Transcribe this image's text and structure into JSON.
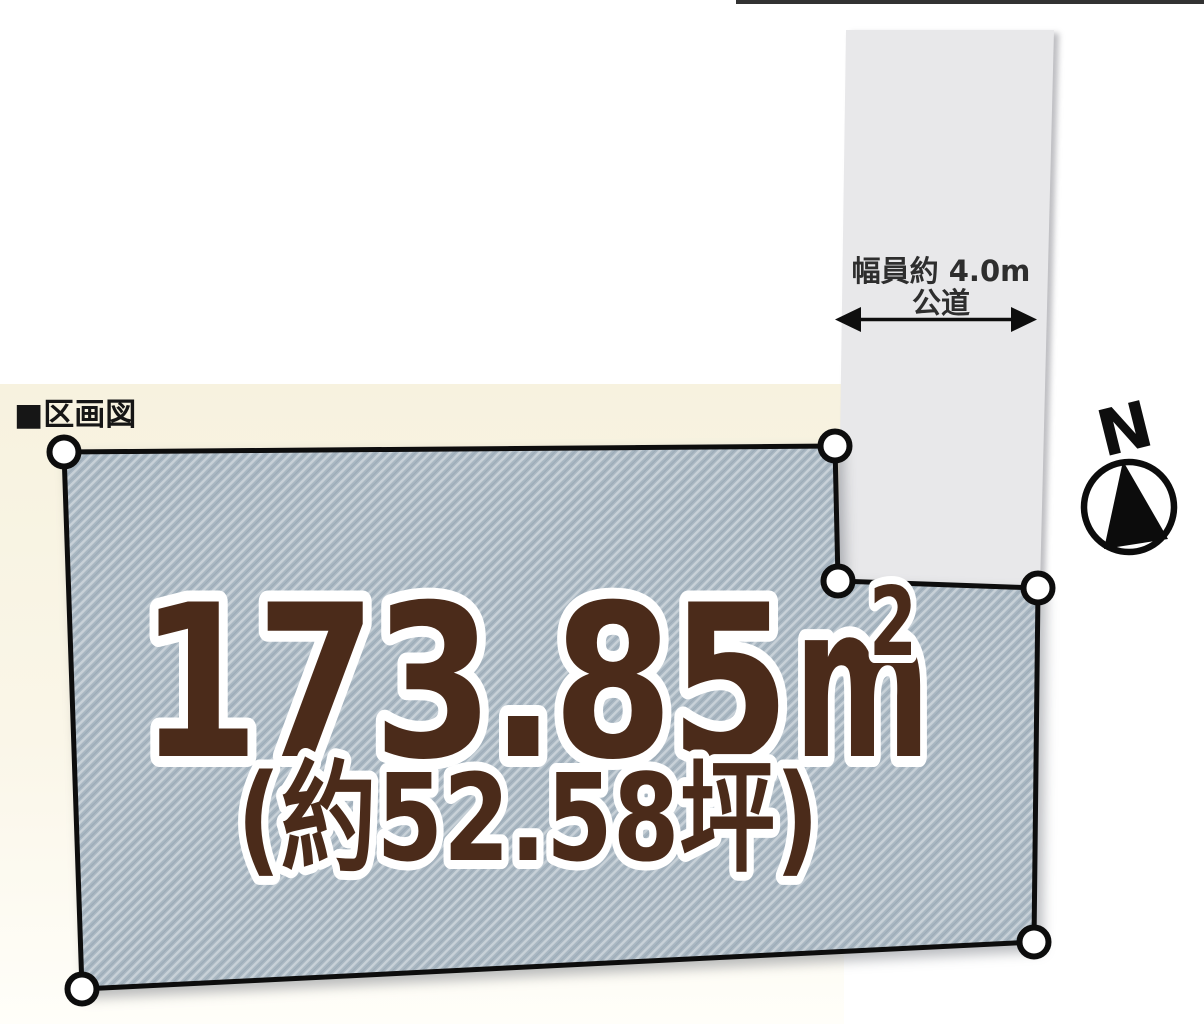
{
  "page": {
    "section_title": "■区画図"
  },
  "road": {
    "width_label": "幅員約 4.0m",
    "name_label": "公道"
  },
  "compass": {
    "north_label": "N"
  },
  "parcel": {
    "area_sqm_value": "173.85",
    "area_sqm_unit": "m",
    "area_sqm_sup": "2",
    "area_tsubo_label": "(約52.58坪)",
    "vertex_count": 6
  },
  "colors": {
    "area_text": "#4b2b1a",
    "area_outline": "#ffffff",
    "parcel_fill_base": "#a9b7c2",
    "parcel_hatch_light": "#c8d1d8",
    "parcel_hatch_dark": "#8d9daa",
    "parcel_border": "#0d0d0d",
    "road_fill": "#e8e8ea",
    "background_cream": "#f7f2df",
    "line_black": "#1c1c1c"
  }
}
